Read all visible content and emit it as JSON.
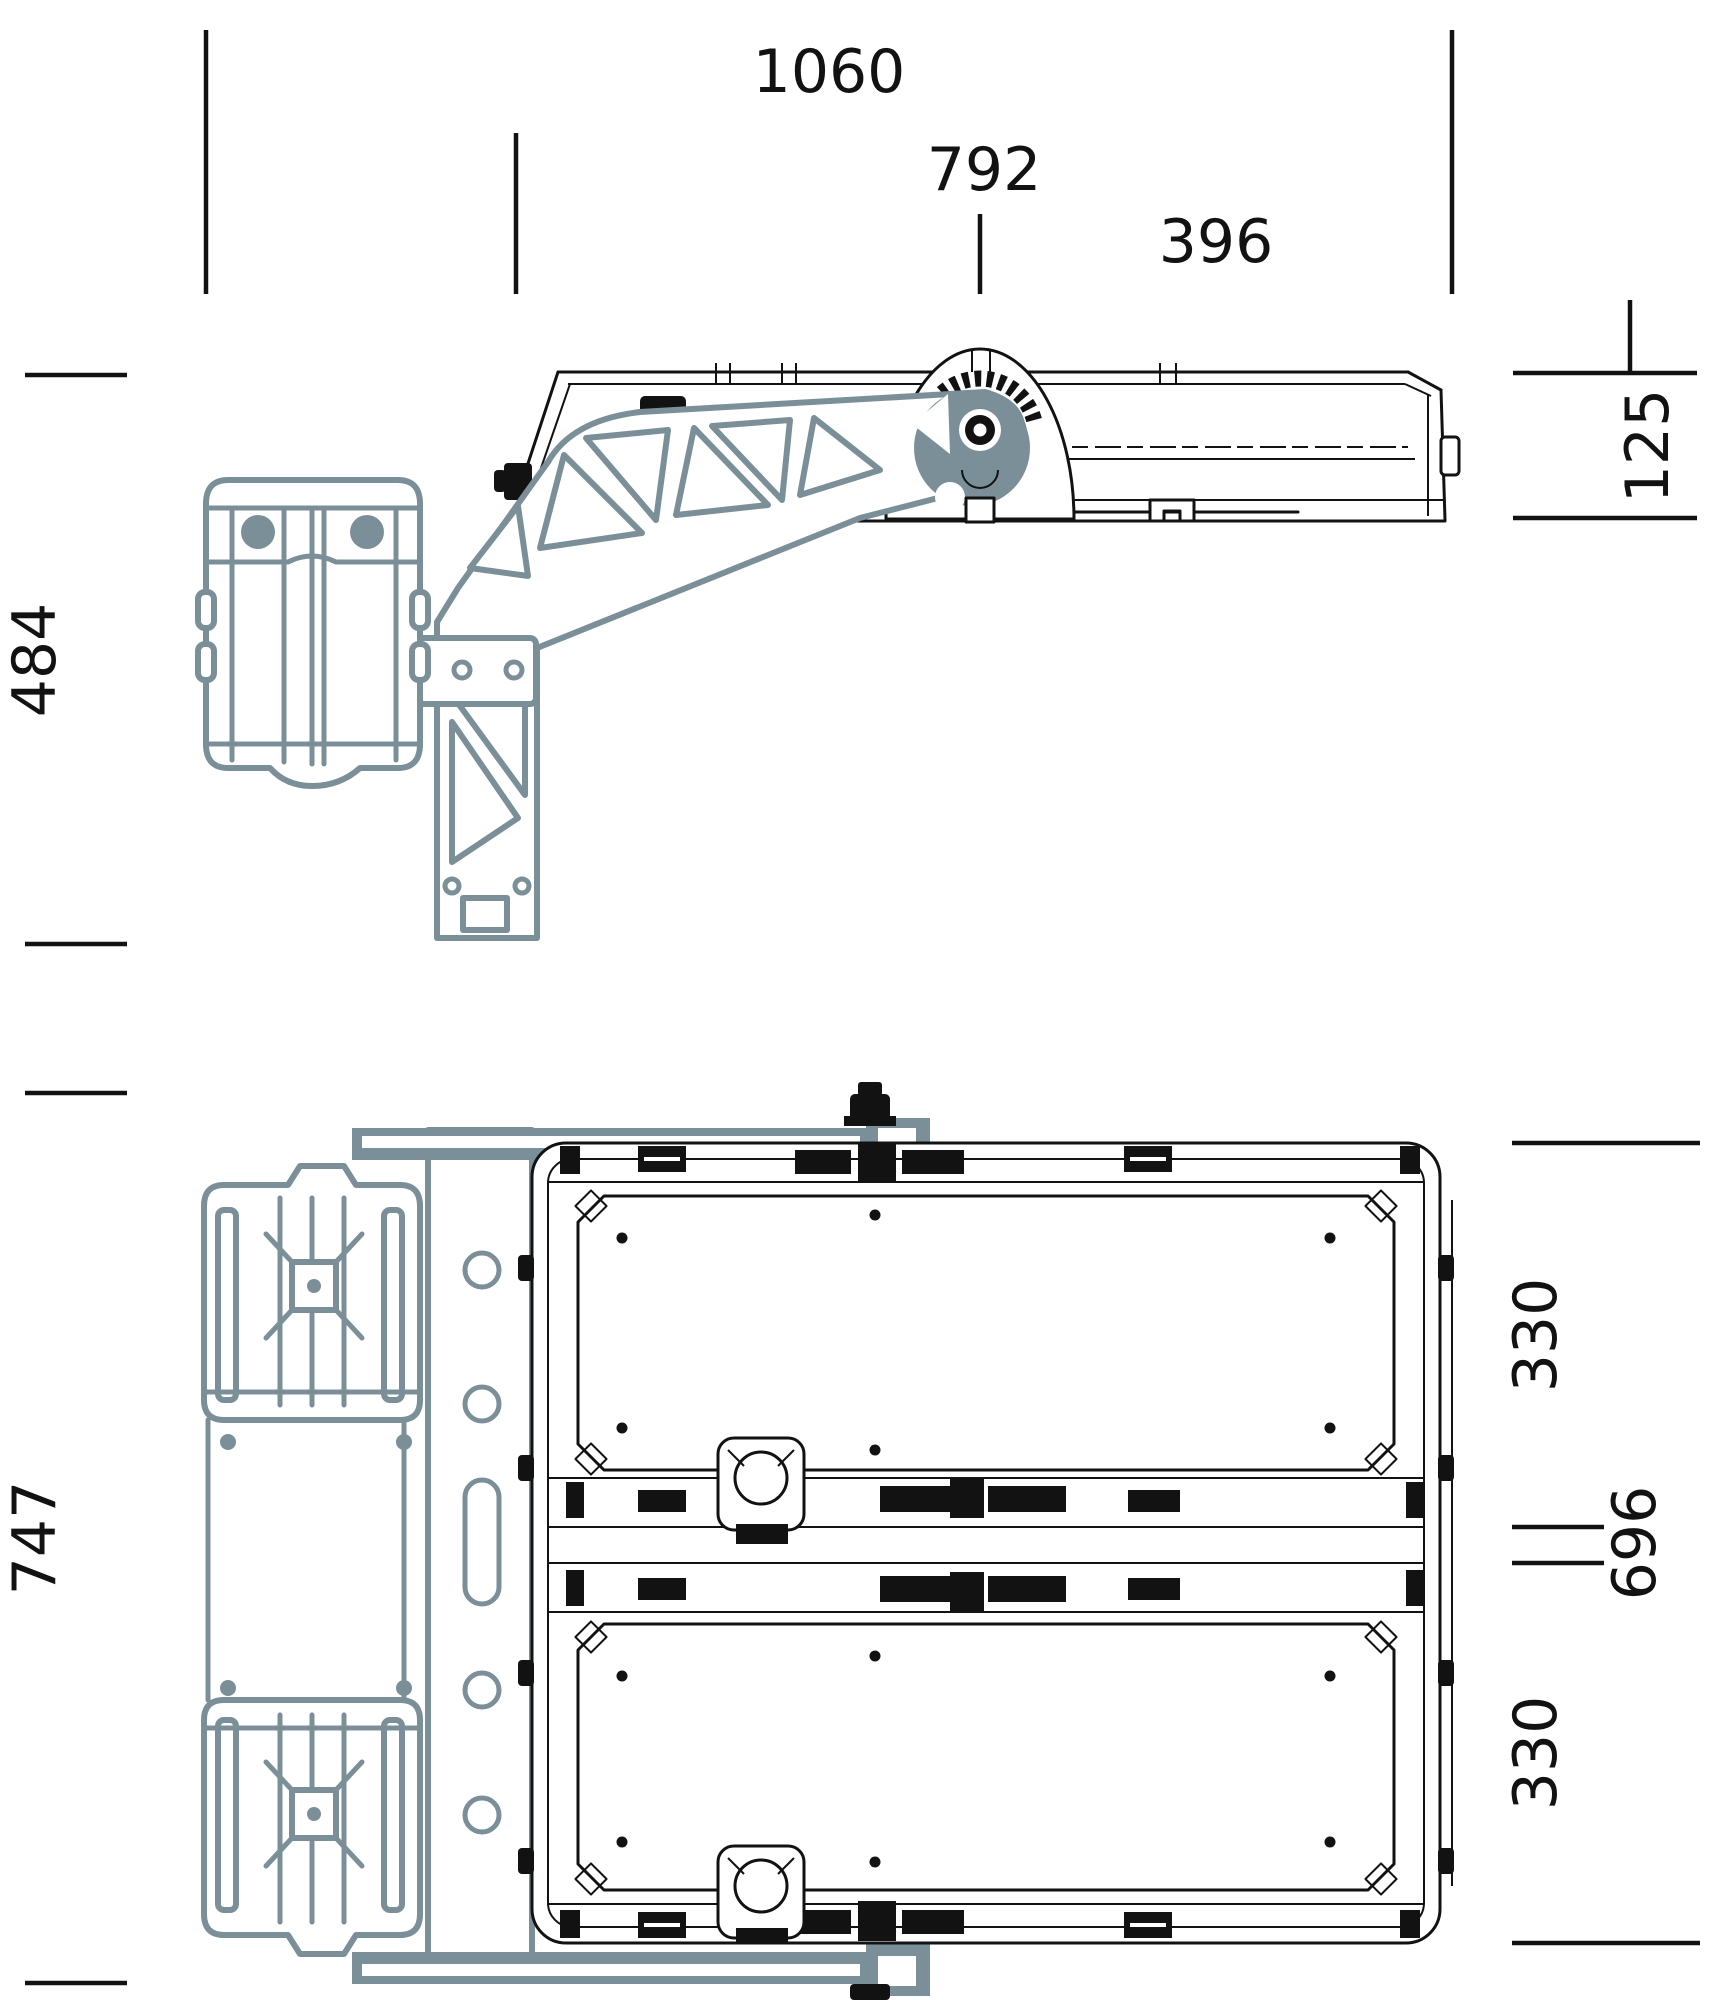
{
  "diagram": {
    "kind": "technical-dimension-drawing",
    "subject": "floodlight-luminaire-with-pole-mount-bracket",
    "colors": {
      "outline": "#121212",
      "bracket": "#7b8f98",
      "background": "#ffffff"
    },
    "views": {
      "side_view": {
        "dims": {
          "overall_width": "1060",
          "body_width": "792",
          "pivot_to_end": "396",
          "housing_height": "125",
          "bracket_height": "484"
        }
      },
      "rear_view": {
        "dims": {
          "upper_module_height": "330",
          "frame_height": "696",
          "lower_module_height": "330",
          "overall_height": "747"
        }
      }
    }
  }
}
